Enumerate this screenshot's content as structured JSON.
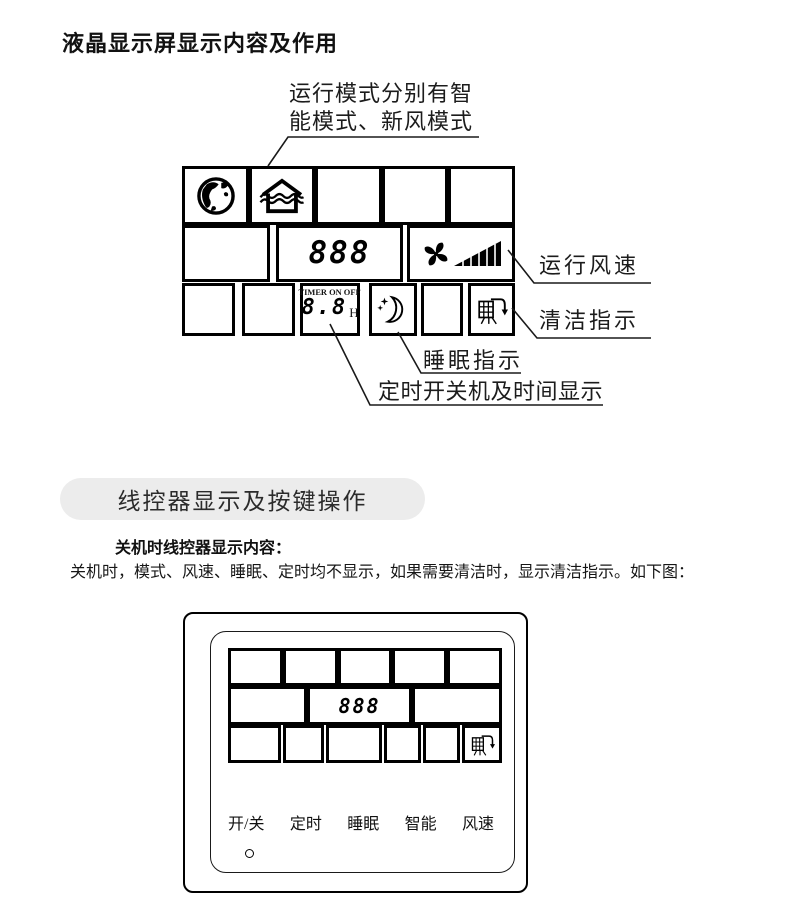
{
  "title": "液晶显示屏显示内容及作用",
  "diagram1": {
    "annotation": "运行模式分别有智\n能模式、新风模式",
    "digits": "888",
    "timer": {
      "label": "TIMER ON OFF",
      "digits": "8.8",
      "unit": "H"
    },
    "labels": {
      "fan_speed": "运行风速",
      "clean": "清洁指示",
      "sleep": "睡眠指示",
      "timer_display": "定时开关机及时间显示"
    }
  },
  "section": {
    "header": "线控器显示及按键操作",
    "subheading": "关机时线控器显示内容：",
    "body": "关机时，模式、风速、睡眠、定时均不显示，如果需要清洁时，显示清洁指示。如下图："
  },
  "controller": {
    "digits": "888",
    "buttons": [
      {
        "label": "开/关"
      },
      {
        "label": "定时"
      },
      {
        "label": "睡眠"
      },
      {
        "label": "智能"
      },
      {
        "label": "风速"
      }
    ]
  },
  "colors": {
    "ink": "#000000",
    "pill_bg": "#ececec"
  }
}
